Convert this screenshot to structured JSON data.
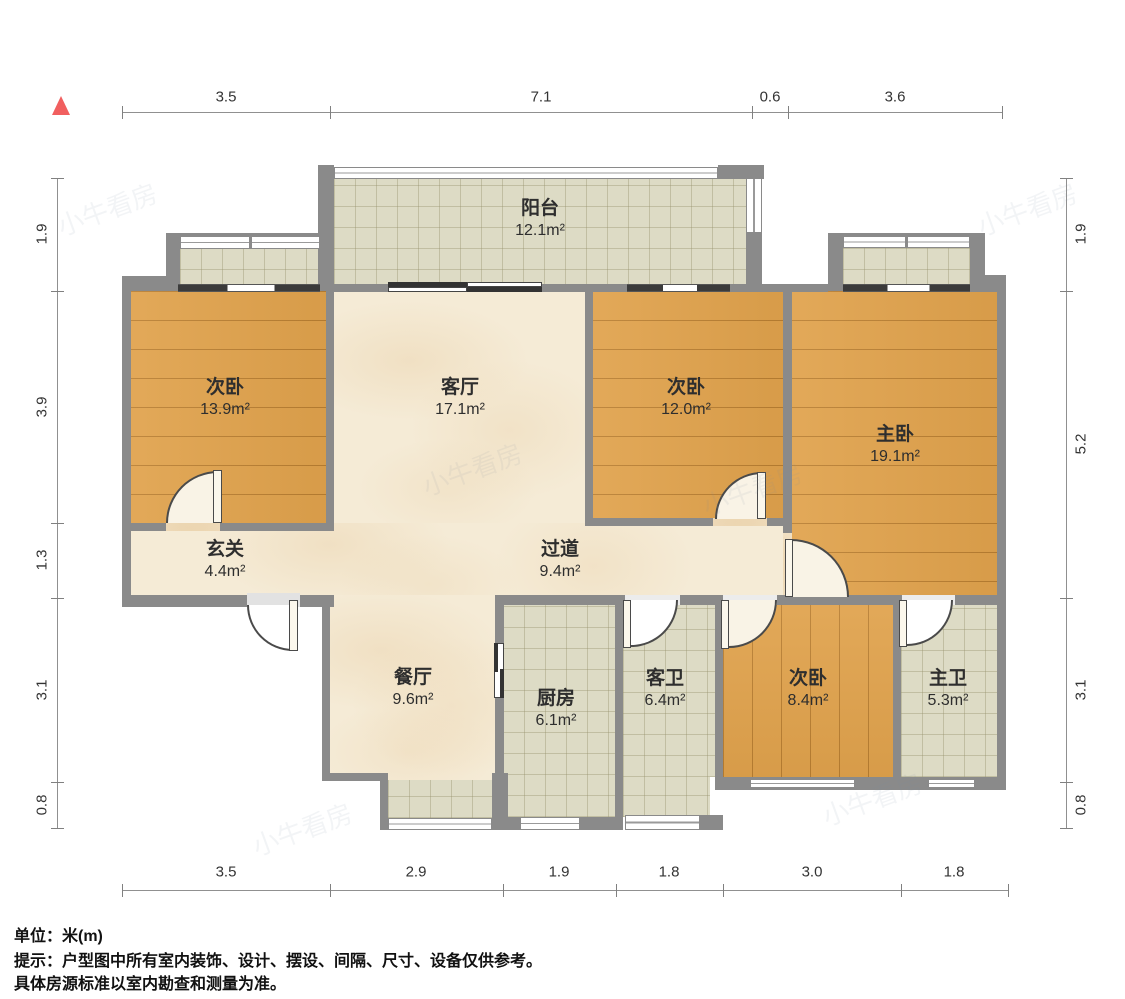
{
  "meta": {
    "unit_note": "单位：米(m)",
    "tip_line1": "提示：户型图中所有室内装饰、设计、摆设、间隔、尺寸、设备仅供参考。",
    "tip_line2": "具体房源标准以室内勘查和测量为准。"
  },
  "watermark": {
    "text": "小牛看房",
    "opacity": 0.09
  },
  "north_indicator": {
    "shape": "triangle",
    "color": "#f15f5f"
  },
  "palette": {
    "wall": "#8a8a8a",
    "wood_floor": "#e0a24c",
    "tile_floor": "#dddbc5",
    "marble_floor": "#f5ebd6",
    "window_frame": "#8a8a8a",
    "dark_window": "#3b3b3b",
    "dimension_text": "#333333"
  },
  "rooms": [
    {
      "name": "阳台",
      "area": "12.1m²"
    },
    {
      "name": "次卧",
      "area": "13.9m²"
    },
    {
      "name": "客厅",
      "area": "17.1m²"
    },
    {
      "name": "次卧",
      "area": "12.0m²"
    },
    {
      "name": "主卧",
      "area": "19.1m²"
    },
    {
      "name": "玄关",
      "area": "4.4m²"
    },
    {
      "name": "过道",
      "area": "9.4m²"
    },
    {
      "name": "餐厅",
      "area": "9.6m²"
    },
    {
      "name": "厨房",
      "area": "6.1m²"
    },
    {
      "name": "客卫",
      "area": "6.4m²"
    },
    {
      "name": "次卧",
      "area": "8.4m²"
    },
    {
      "name": "主卫",
      "area": "5.3m²"
    }
  ],
  "dimensions": {
    "top": [
      "3.5",
      "7.1",
      "0.6",
      "3.6"
    ],
    "bottom": [
      "3.5",
      "2.9",
      "1.9",
      "1.8",
      "3.0",
      "1.8"
    ],
    "left": [
      "1.9",
      "3.9",
      "1.3",
      "3.1",
      "0.8"
    ],
    "right": [
      "1.9",
      "5.2",
      "3.1",
      "0.8"
    ]
  }
}
